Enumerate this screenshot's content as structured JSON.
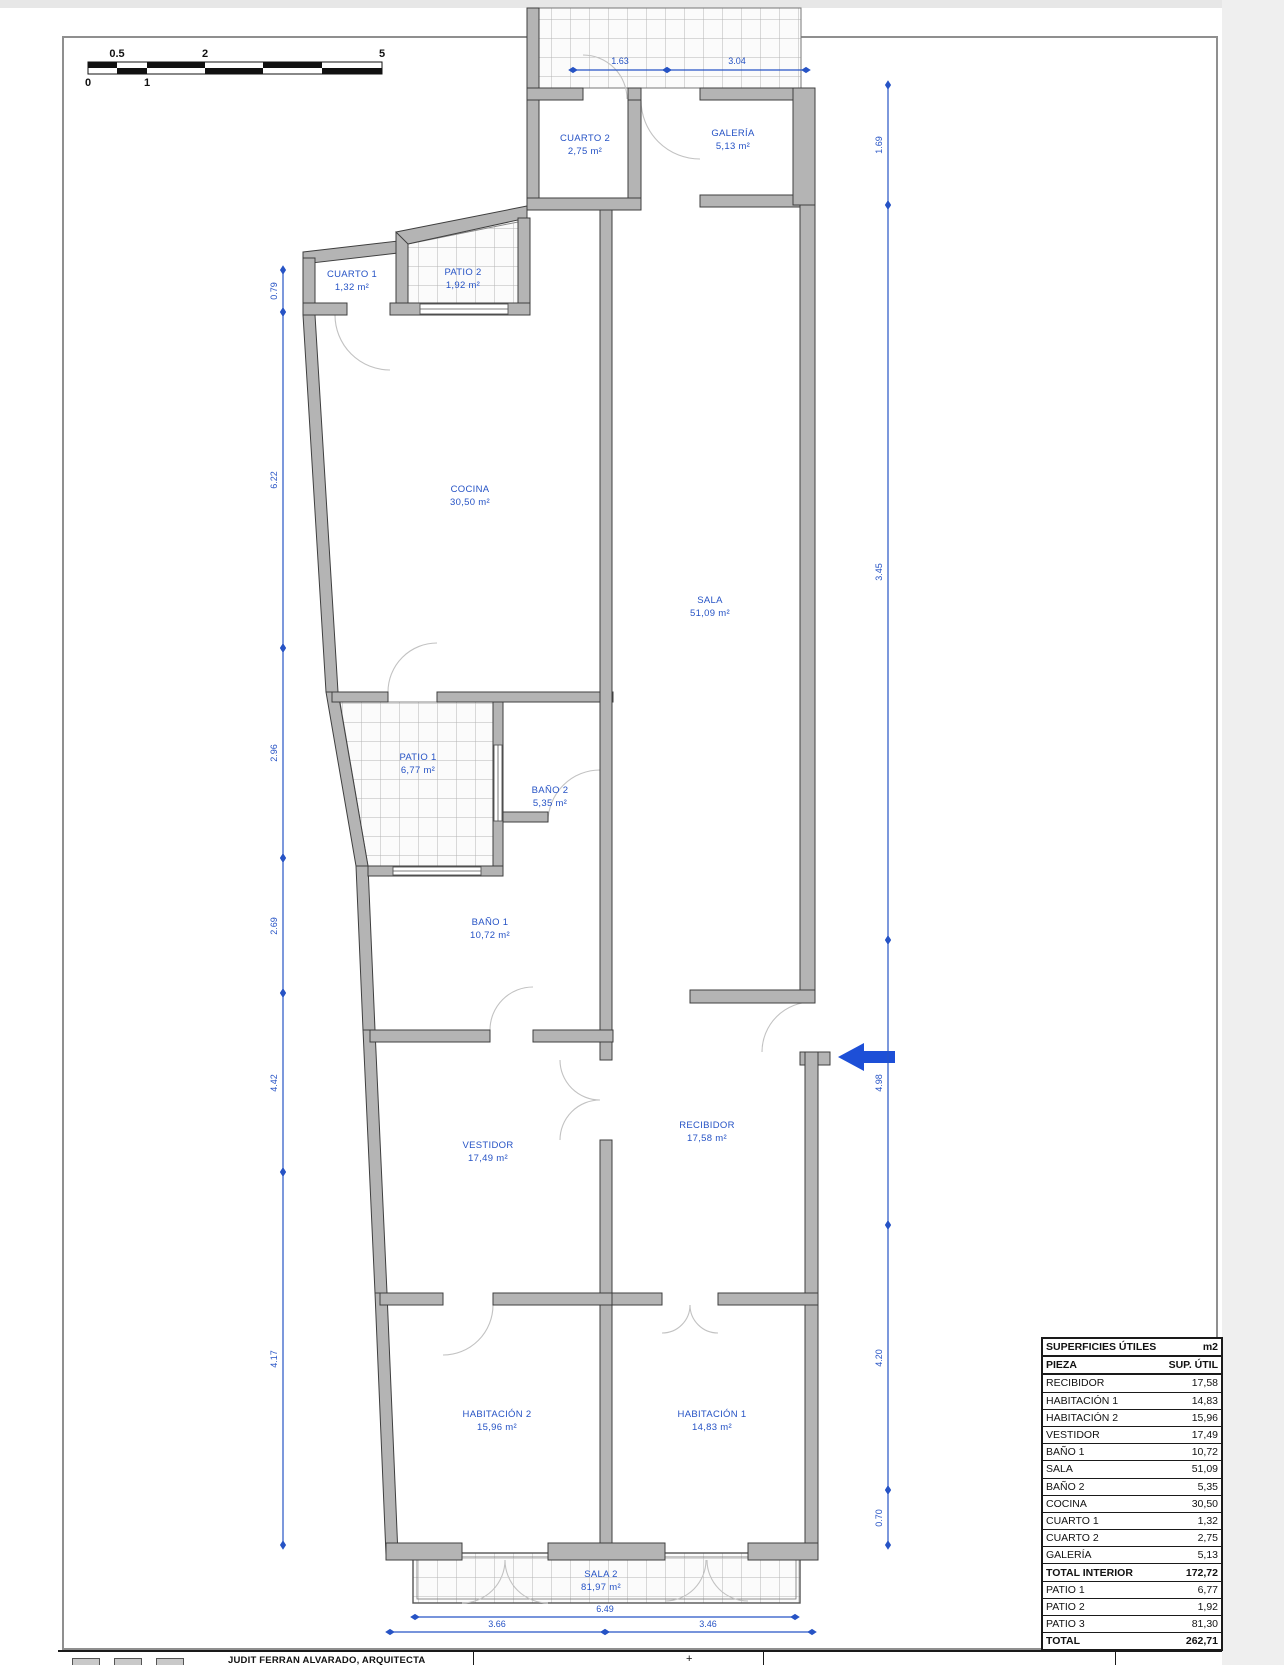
{
  "page": {
    "architect_line": "JUDIT FERRAN ALVARADO, ARQUITECTA",
    "plus_mark": "+"
  },
  "scale_bar": {
    "above": [
      "0.5",
      "2",
      "5"
    ],
    "below": [
      "0",
      "1"
    ]
  },
  "rooms": [
    {
      "name": "CUARTO 2",
      "area": "2,75 m²"
    },
    {
      "name": "GALERÍA",
      "area": "5,13 m²"
    },
    {
      "name": "CUARTO 1",
      "area": "1,32 m²"
    },
    {
      "name": "PATIO 2",
      "area": "1,92 m²"
    },
    {
      "name": "COCINA",
      "area": "30,50 m²"
    },
    {
      "name": "SALA",
      "area": "51,09 m²"
    },
    {
      "name": "PATIO 1",
      "area": "6,77 m²"
    },
    {
      "name": "BAÑO 2",
      "area": "5,35 m²"
    },
    {
      "name": "BAÑO 1",
      "area": "10,72 m²"
    },
    {
      "name": "VESTIDOR",
      "area": "17,49 m²"
    },
    {
      "name": "RECIBIDOR",
      "area": "17,58 m²"
    },
    {
      "name": "HABITACIÓN 2",
      "area": "15,96 m²"
    },
    {
      "name": "HABITACIÓN 1",
      "area": "14,83 m²"
    },
    {
      "name": "SALA 2",
      "area": "81,97 m²"
    }
  ],
  "dims": {
    "top": [
      "1.63",
      "3.04"
    ],
    "left": [
      "0.79",
      "6.22",
      "2.96",
      "2.69",
      "4.42",
      "4.17"
    ],
    "right": [
      "1.69",
      "3.45",
      "4.98",
      "4.20",
      "0.70"
    ],
    "bottom": [
      "6.49",
      "3.66",
      "3.46"
    ]
  },
  "table": {
    "title": "SUPERFICIES ÚTILES",
    "unit": "m2",
    "col_piece": "PIEZA",
    "col_sup": "SUP. ÚTIL",
    "rows": [
      {
        "label": "RECIBIDOR",
        "value": "17,58"
      },
      {
        "label": "HABITACIÓN 1",
        "value": "14,83"
      },
      {
        "label": "HABITACIÓN 2",
        "value": "15,96"
      },
      {
        "label": "VESTIDOR",
        "value": "17,49"
      },
      {
        "label": "BAÑO 1",
        "value": "10,72"
      },
      {
        "label": "SALA",
        "value": "51,09"
      },
      {
        "label": "BAÑO 2",
        "value": "5,35"
      },
      {
        "label": "COCINA",
        "value": "30,50"
      },
      {
        "label": "CUARTO 1",
        "value": "1,32"
      },
      {
        "label": "CUARTO 2",
        "value": "2,75"
      },
      {
        "label": "GALERÍA",
        "value": "5,13"
      },
      {
        "label": "TOTAL INTERIOR",
        "value": "172,72"
      },
      {
        "label": "PATIO 1",
        "value": "6,77"
      },
      {
        "label": "PATIO 2",
        "value": "1,92"
      },
      {
        "label": "PATIO 3",
        "value": "81,30"
      },
      {
        "label": "TOTAL",
        "value": "262,71"
      }
    ]
  },
  "colors": {
    "blue": "#2653c5",
    "wall_fill": "#b4b4b4",
    "wall_stroke": "#3f3f3f"
  }
}
